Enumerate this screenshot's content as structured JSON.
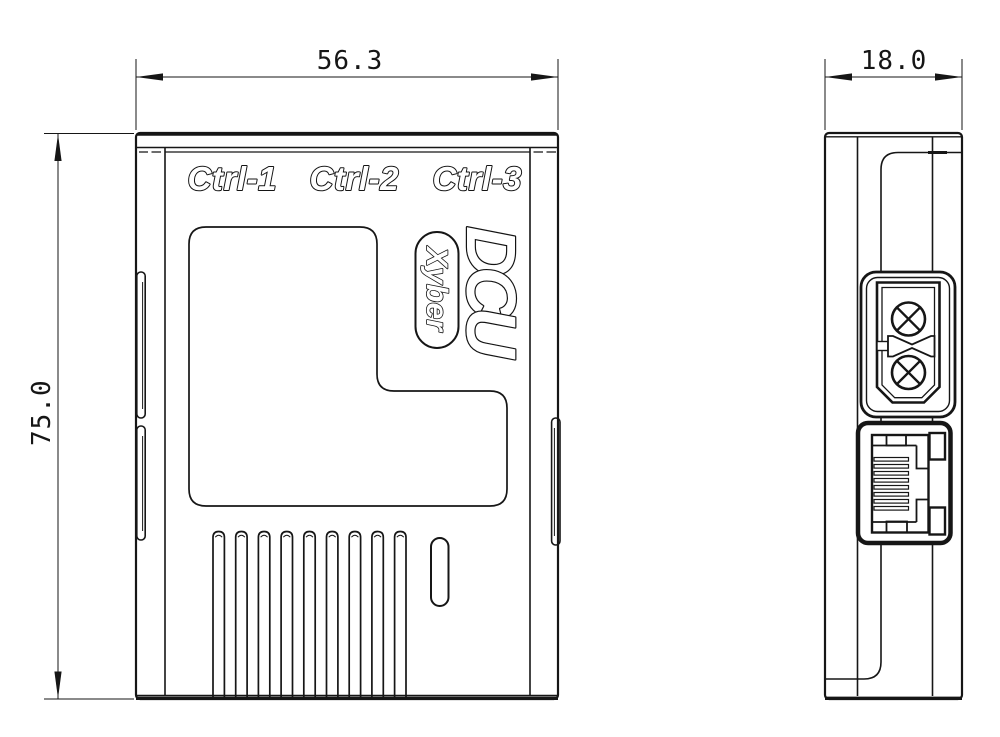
{
  "title": "DCU enclosure technical drawing",
  "colors": {
    "line": "#141414",
    "background": "#ffffff"
  },
  "dimensions": {
    "width": {
      "value": "56.3"
    },
    "height": {
      "value": "75.0"
    },
    "depth": {
      "value": "18.0"
    }
  },
  "front_view": {
    "port_labels": [
      "Ctrl-1",
      "Ctrl-2",
      "Ctrl-3"
    ],
    "logo": "DCU",
    "brand": "Xyber",
    "vent_fin_count": 9
  },
  "side_view": {
    "ethernet_contact_count": 8
  }
}
